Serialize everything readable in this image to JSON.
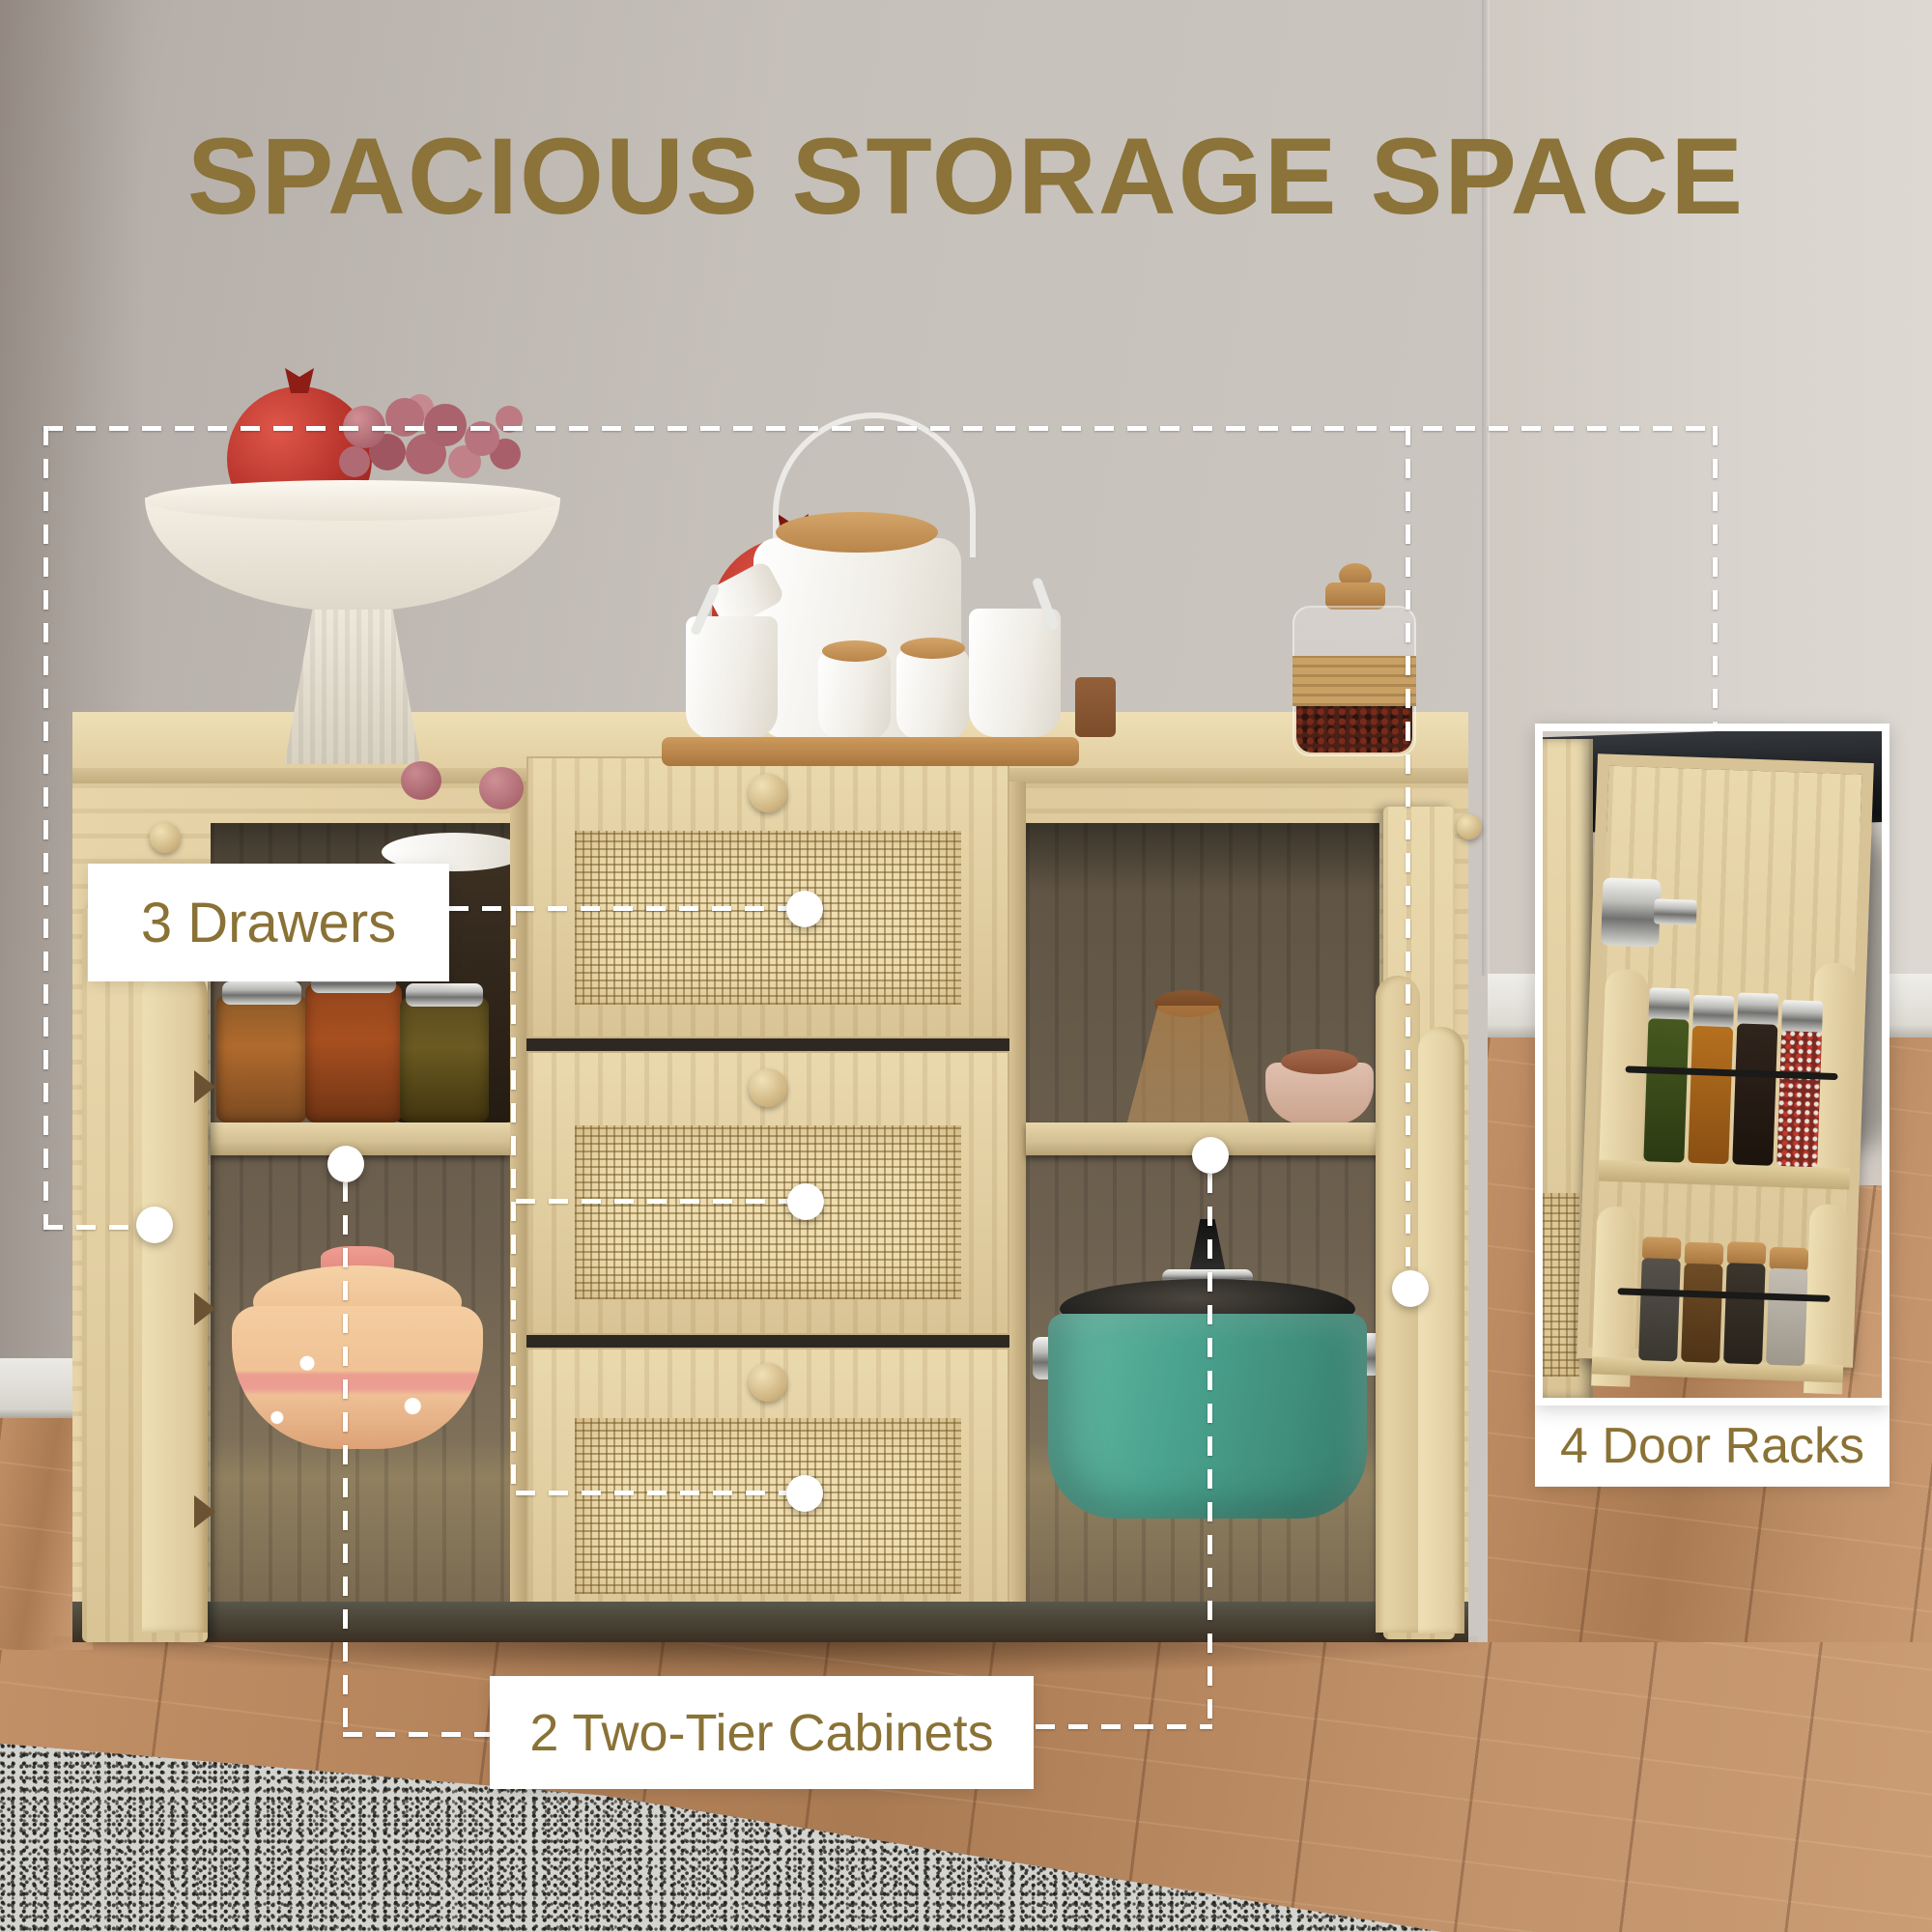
{
  "title": {
    "text": "SPACIOUS STORAGE SPACE"
  },
  "callouts": {
    "drawers": {
      "label": "3 Drawers"
    },
    "two_tier": {
      "label": "2 Two-Tier Cabinets"
    },
    "door_racks": {
      "label": "4 Door Racks"
    }
  },
  "palette": {
    "accent_text": "#8a7236",
    "title_text": "#8b7339",
    "callout_line": "#ffffff",
    "wood_light": "#e3d0a2",
    "rattan": "#eeddae",
    "cabinet_interior": "#6e6150",
    "teal_pot": "#4aa38f",
    "clay_pot": "#f0c79c",
    "wall": "#c4beb8",
    "floor": "#b9875f"
  },
  "scene": {
    "items": [
      "sideboard with rattan drawer fronts",
      "open left cabinet door",
      "open right cabinet door",
      "fruit bowl with pomegranates and grapes",
      "white tea set on bamboo tray",
      "cork-top spice jar",
      "glass jars with dried food",
      "clay pot with flower pattern",
      "teal cooking pot",
      "door-mounted spice racks with jars",
      "grey speckled rug",
      "wood plank floor"
    ]
  }
}
